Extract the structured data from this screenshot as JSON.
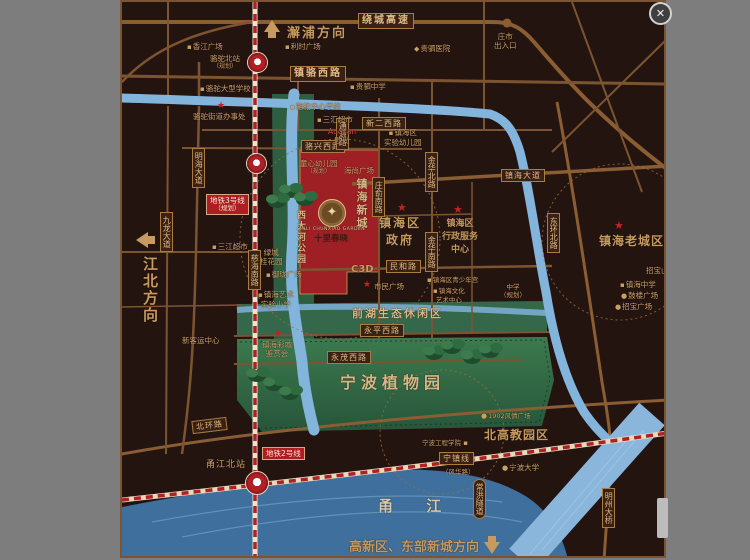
{
  "window": {
    "close_glyph": "✕"
  },
  "colors": {
    "page_bg": "#7d7d7d",
    "map_bg": "#241410",
    "road": "#7d5430",
    "river": "#82b4dc",
    "yongjiang_river": "#3f6f9c",
    "park_green": "#2e5e40",
    "site_red": "#9e2025",
    "gold_text": "#c79a5f",
    "metro_red": "#b02025"
  },
  "directions": {
    "north": "澥浦方向",
    "west": "江北方向",
    "south": "高新区、东部新城方向"
  },
  "roads": {
    "raocheng_gaosu": "绕城高速",
    "exit_l1": "庄市",
    "exit_l2": "出入口",
    "zhenluo_xilu": "镇骆西路",
    "xiner_xilu": "新二西路",
    "luoxing_xilu": "骆兴西路",
    "tongyuan_lu": "通源路",
    "minghai_dadao": "明海大道",
    "jiulong_dadao": "九龙大道",
    "cihai_nanlu": "慈海南路",
    "zhuangyu_nanlu": "庄俞南路",
    "jinhua_beilu": "金华北路",
    "jinhua_nanlu": "金华南路",
    "minhe_lu": "民和路",
    "zhenhai_dadao": "镇海大道",
    "donghuan_beilu": "东环北路",
    "yongping_xilu": "永平西路",
    "yongmao_xilu": "永茂西路",
    "beihuan_lu": "北环路",
    "ningzhen_xian": "宁镇线",
    "ningzhen_sub": "（风华路）",
    "changhong_suidao": "常洪隧道",
    "mingzhou_daqiao": "明州大桥"
  },
  "metro": {
    "line3_l1": "地铁3号线",
    "line3_l2": "（规划）",
    "line2": "地铁2号线",
    "luotuo_beizhan_l1": "骆驼北站",
    "luotuo_beizhan_l2": "（规划）",
    "yongjiang_beizhan": "甬江北站"
  },
  "areas": {
    "xidahe_park": "西大河公园",
    "qianhu": "前湖生态休闲区",
    "botanical": "宁波植物园",
    "laochengqu": "镇海老城区",
    "beigaojiao": "北高教园区",
    "c3d_l1": "镇海新城",
    "c3d_l2": "C3D",
    "yongjiang": "甬  江"
  },
  "project": {
    "name_cn": "十里春晓",
    "name_en": "SHILI CHUNXIAO GARDEN",
    "emblem_glyph": "✦"
  },
  "pois": {
    "xiangjiang_plaza": "香江广场",
    "lishi_plaza": "利时广场",
    "guisi_hospital": "贵驷医院",
    "guisi_middle": "贵驷中学",
    "luotuo_school": "骆驼大型学校",
    "luotuo_office": "骆驼街道办事处",
    "luotuo_central_school": "骆驼中心学校",
    "sanhui_market": "三汇超市",
    "tongxin_kg_l1": "童心幼儿园",
    "tongxin_kg_l2": "（规划）",
    "auchan_l1": "Auchan",
    "auchan_l2": "欧尚",
    "haishang_plaza": "海尚广场",
    "shiyan_kg_l1": "镇海区",
    "shiyan_kg_l2": "实验幼儿园",
    "sanjiang_market": "三江超市",
    "xinkeyun": "新客运中心",
    "lvcheng_l1": "绿城",
    "lvcheng_l2": "桂花园",
    "yulong_plaza": "御珑广场",
    "art_school_l1": "镇海艺术",
    "art_school_l2": "实验小学",
    "caicheng_l1": "镇海彩城",
    "caicheng_l2": "鉴赏会",
    "shimin_plaza": "市民广场",
    "gov_l1": "镇海区",
    "gov_l2": "政府",
    "xingzheng_l1": "镇海区",
    "xingzheng_l2": "行政服务",
    "xingzheng_l3": "中心",
    "qingshaonian": "镇海区青少年宫",
    "wenhua_l1": "镇海文化",
    "wenhua_l2": "艺术中心",
    "school_planned_l1": "中学",
    "school_planned_l2": "（规划）",
    "zhenhai_zhongxue": "镇海中学",
    "gulou_plaza": "鼓楼广场",
    "zhaobao_plaza": "招宝广场",
    "zhaobaoshan": "招宝山大桥",
    "ningbo_eng": "宁波工程学院",
    "f1902": "1902风情广场",
    "ningbo_univ": "宁波大学"
  }
}
